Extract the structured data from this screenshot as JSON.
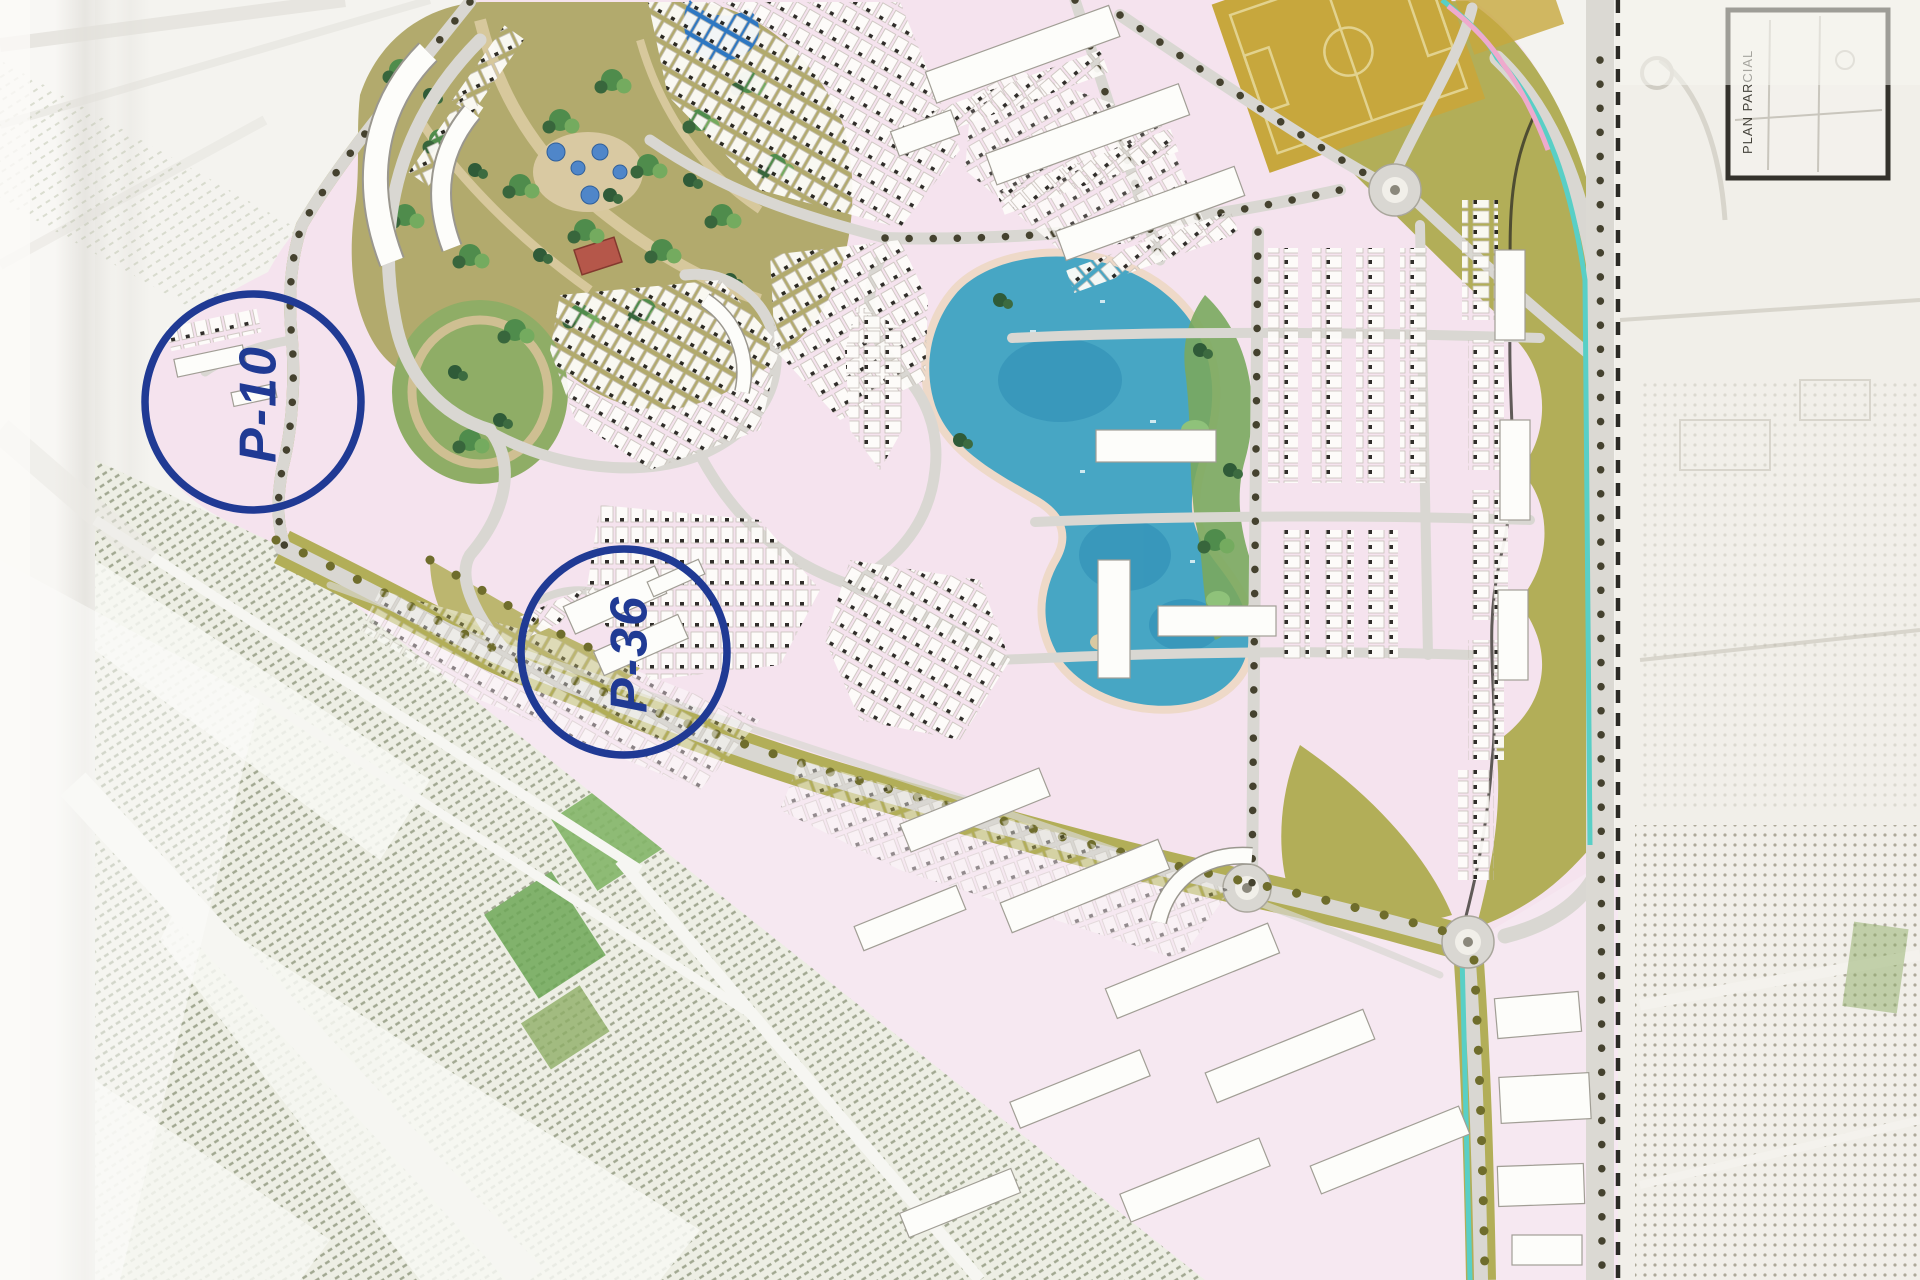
{
  "document": {
    "kind": "scanned-masterplan-site-plan",
    "description": "Scanned colored master plan of a resort-style residential development with central lake, park, sports fields, perimeter roads and surrounding agricultural fields"
  },
  "annotations": {
    "color": "#203a94",
    "p10": {
      "label": "P-10",
      "cx": 253,
      "cy": 402,
      "r": 108
    },
    "p36": {
      "label": "P-36",
      "cx": 624,
      "cy": 652,
      "r": 103
    }
  },
  "keymap": {
    "label": "PLAN PARCIAL"
  },
  "palette": {
    "paper": "#f4f3ef",
    "parcel": "#f5e3ee",
    "parcelSouth": "#f6e8f1",
    "lake": "#47a6c4",
    "lakeShore": "#eed9c8",
    "pond": "#2e77c2",
    "park": "#b2aa6d",
    "parkOval": "#8fad66",
    "olive": "#b2ae58",
    "sports": "#c7a73d",
    "road": "#d9d7d2",
    "treeDot": "#45422f",
    "navy": "#203a94",
    "fieldBase": "#edeee4",
    "boundary": "#2b2a25",
    "building": "#fdfdfa",
    "canal": "#59cfc6"
  }
}
